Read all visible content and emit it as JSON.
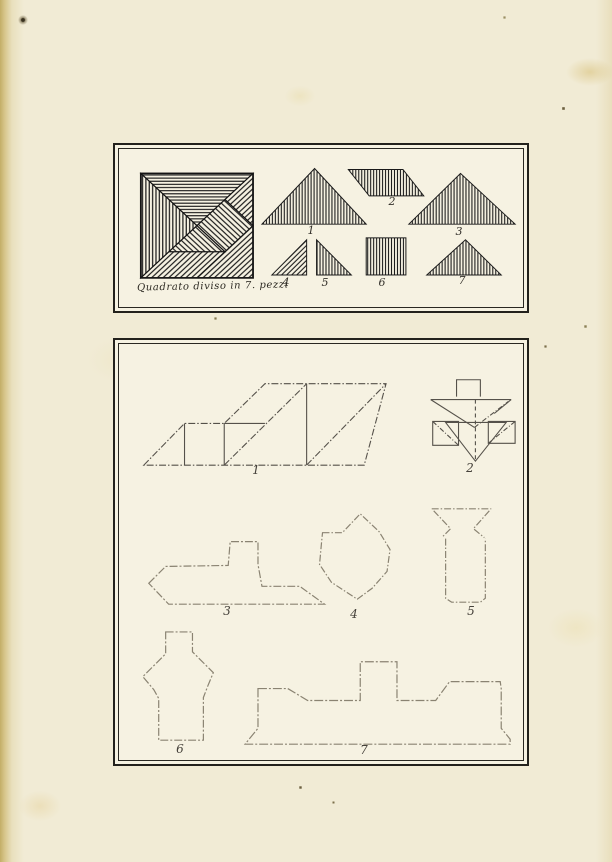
{
  "plate_top": {
    "caption": "Quadrato diviso in 7. pezzi",
    "piece_labels": [
      "1",
      "2",
      "3",
      "4",
      "5",
      "6",
      "7"
    ]
  },
  "plate_bottom": {
    "figure_labels": [
      "1",
      "2",
      "3",
      "4",
      "5",
      "6",
      "7"
    ]
  },
  "colors": {
    "ink": "#1a1a1a",
    "paper": "#f1ebd5",
    "faint_line": "#8a8372",
    "medium_line": "#5d5950",
    "stain": "#e4ce70"
  }
}
